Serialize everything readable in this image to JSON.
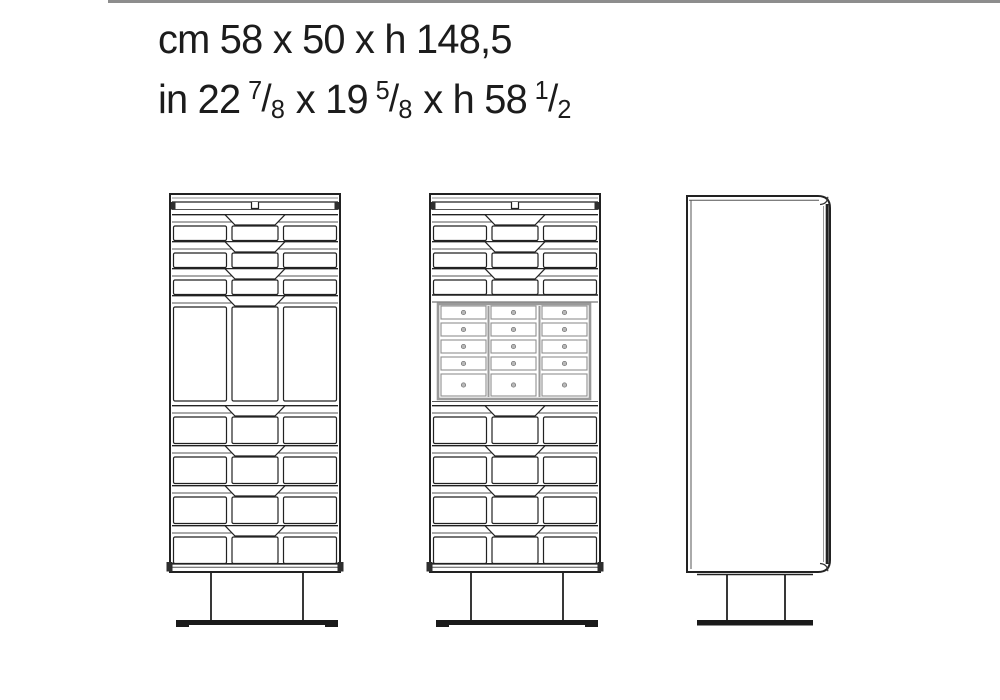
{
  "title_block": {
    "cm_line": "cm 58 x 50 x h 148,5",
    "in_prefix": "in 22",
    "in_sep1": "x 19",
    "in_sep2": "x h 58",
    "fractions": [
      {
        "num": "7",
        "slash": "/",
        "den": "8"
      },
      {
        "num": "5",
        "slash": "/",
        "den": "8"
      },
      {
        "num": "1",
        "slash": "/",
        "den": "2"
      }
    ]
  },
  "views": {
    "front_closed": "front elevation, drawers closed",
    "front_open": "front elevation, open centre compartment with small-drawer grid",
    "side": "side elevation"
  },
  "drawing": {
    "top_drawer_groups": 3,
    "bottom_drawer_groups": 4,
    "grid_columns": 3,
    "grid_rows": 5
  },
  "colors": {
    "line": "#222222",
    "secondary_line": "#555555",
    "grid_frame": "#9a9a9a",
    "knob_fill": "#b8b8b8",
    "base_fill": "#1a1a1a",
    "top_rule": "#8d8d8d"
  }
}
